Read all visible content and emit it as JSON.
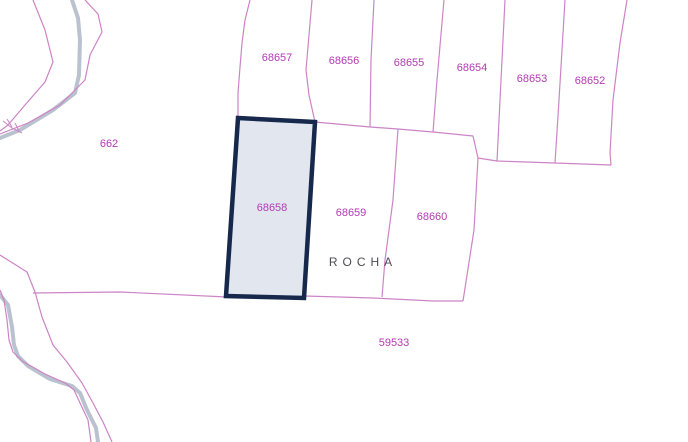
{
  "map": {
    "type": "cadastral-parcel-map",
    "selected_parcel": "68658",
    "place_label": "ROCHA",
    "parcels": [
      {
        "label": "662"
      },
      {
        "label": "68657"
      },
      {
        "label": "68656"
      },
      {
        "label": "68655"
      },
      {
        "label": "68654"
      },
      {
        "label": "68653"
      },
      {
        "label": "68652"
      },
      {
        "label": "68658"
      },
      {
        "label": "68659"
      },
      {
        "label": "68660"
      },
      {
        "label": "59533"
      }
    ],
    "colors": {
      "background": "#ffffff",
      "parcel_boundary_line": "#cc84c6",
      "parcel_label_text": "#b23ab2",
      "selected_parcel_border": "#16294d",
      "selected_parcel_fill": "#e1e6ef",
      "stream_line": "#b9c2ce",
      "place_label_text": "#4b4b52"
    }
  }
}
